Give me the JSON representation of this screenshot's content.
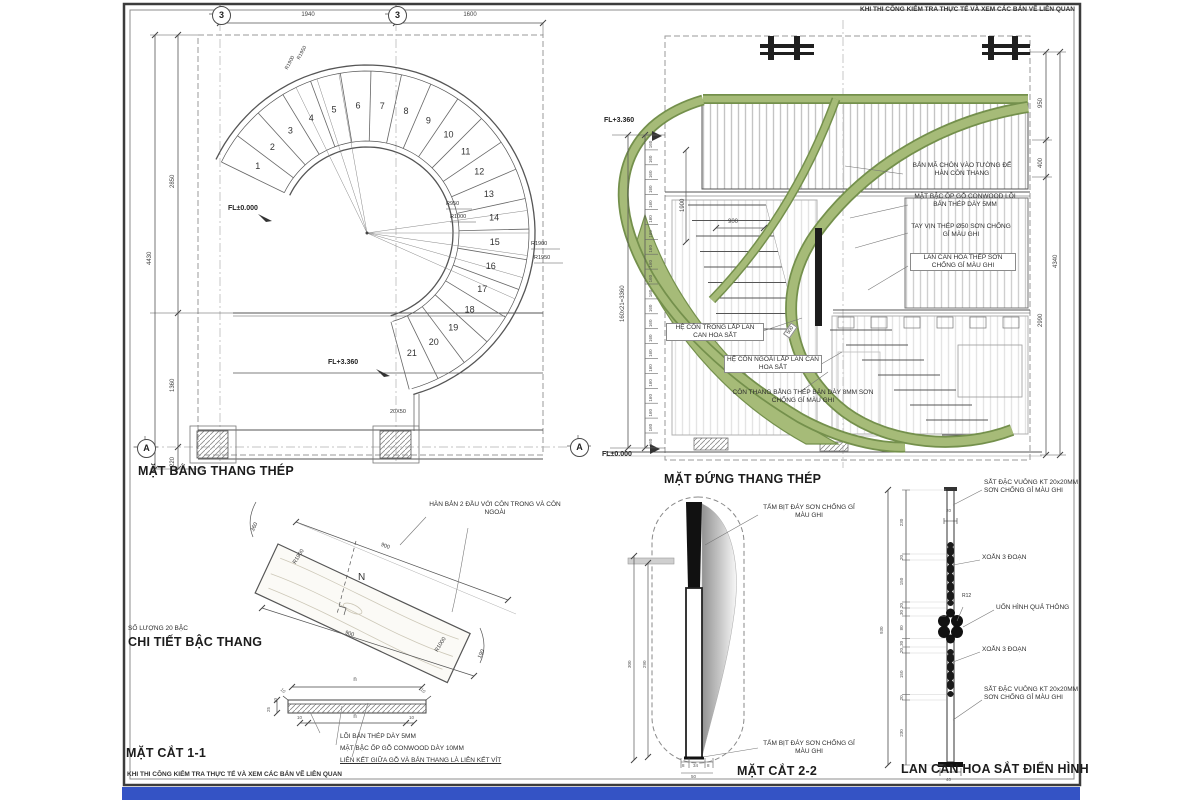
{
  "sheet_note": "KHI THI CÔNG KIỂM TRA THỰC TẾ VÀ XEM CÁC BẢN VẼ LIÊN QUAN",
  "colors": {
    "railing_green": "#a6bb78",
    "railing_green_dark": "#74904c",
    "blue_bar": "#3453c5",
    "line": "#555555"
  },
  "plan": {
    "title": "MẶT BẰNG THANG THÉP",
    "grid_cols": [
      "3",
      "3"
    ],
    "grid_rows": [
      "A",
      "A"
    ],
    "dims_top": [
      "1940",
      "1600"
    ],
    "dims_left": [
      "2850",
      "1360",
      "220"
    ],
    "dim_left_total": "4430",
    "level_base": "FL±0.000",
    "level_top": "FL+3.360",
    "radii_inner": [
      "R950",
      "R1000"
    ],
    "radii_outer": [
      "R1900",
      "R1950"
    ],
    "column_dim": "20X50",
    "steps": [
      "1",
      "2",
      "3",
      "4",
      "5",
      "6",
      "7",
      "8",
      "9",
      "10",
      "11",
      "12",
      "13",
      "14",
      "15",
      "16",
      "17",
      "18",
      "19",
      "20",
      "21"
    ]
  },
  "elevation": {
    "title": "MẶT ĐỨNG THANG THÉP",
    "level_top": "FL+3.360",
    "level_base": "FL±0.000",
    "riser_label": "160",
    "riser_formula": "160x21=3360",
    "dim_height": "1900",
    "dim_width": "900",
    "dim_stringer": "500",
    "dims_right": [
      "950",
      "400",
      "2990"
    ],
    "dim_right_total": "4340",
    "callout_plate": "BẢN MÃ CHÔN VÀO TƯỜNG ĐỂ HÀN CÔN THANG",
    "callout_tread": "MẶT BẬC ỐP GỖ CONWOOD LÕI BẢN THÉP DÀY 5MM",
    "callout_handrail": "TAY VỊN THÉP Ø50 SƠN CHỐNG GỈ MÀU GHI",
    "callout_railing": "LAN CAN HOA THÉP SƠN CHỐNG GỈ MÀU GHI",
    "callout_inner_stringer": "HỆ CÔN TRONG LẮP LAN CAN HOA SẮT",
    "callout_outer_stringer": "HỆ CÔN NGOÀI LẮP LAN CAN HOA SẮT",
    "callout_stringer_plate": "CÔN THANG BẰNG THÉP BẢN DÀY 8MM SƠN CHỐNG GỈ MÀU GHI"
  },
  "step_detail": {
    "qty_note": "SỐ LƯỢNG 20 BẬC",
    "title": "CHI TIẾT BẬC THANG",
    "callout_weld": "HÀN BẢN 2 ĐẦU VỚI CÔN TRONG VÀ CÔN NGOÀI",
    "dim_edge_outer": "900",
    "dim_edge_inner": "900",
    "dim_end_left": "360",
    "dim_end_right": "190",
    "radius_outer": "R1900",
    "radius_inner": "R1000",
    "axis_label": "N"
  },
  "section_1_1": {
    "title": "MẶT CẮT 1-1",
    "dim_top": "n",
    "dim_bottom": "n",
    "dim_corner": "10",
    "dim_end": "10",
    "dims_left": [
      "25",
      "10"
    ],
    "callouts": [
      "LÕI BẢN THÉP DÀY 5MM",
      "MẶT BẬC ỐP GỖ CONWOOD DÀY 10MM",
      "LIÊN KẾT GIỮA GỖ VÀ BẢN THANG LÀ LIÊN KẾT VÍT"
    ]
  },
  "section_2_2": {
    "title": "MẶT CẮT 2-2",
    "callout_cap_top": "TẤM BỊT ĐÁY SƠN CHỐNG GỈ MÀU GHI",
    "callout_cap_bottom": "TẤM BỊT ĐÁY SƠN CHỐNG GỈ MÀU GHI",
    "dim_height_outer": "300",
    "dim_height_inner": "290",
    "dims_bottom": [
      "8",
      "34",
      "8"
    ],
    "dim_bottom_total": "50"
  },
  "railing_detail": {
    "title": "LAN CAN HOA SẮT ĐIỂN HÌNH",
    "callout_bar_top": "SẮT ĐẶC VUÔNG KT 20x20MM SƠN CHỐNG GỈ MÀU GHI",
    "callout_bar_bottom": "SẮT ĐẶC VUÔNG KT 20x20MM SƠN CHỐNG GỈ MÀU GHI",
    "callout_twist_top": "XOẮN 3 ĐOẠN",
    "callout_twist_bottom": "XOẮN 3 ĐOẠN",
    "callout_ornament": "UỐN HÌNH QUẢ THÔNG",
    "ornament_radius": "R12",
    "dims_left": [
      "230",
      "20",
      "150",
      "20",
      "30",
      "80",
      "30",
      "20",
      "150",
      "20",
      "230"
    ],
    "dim_total": "930",
    "dim_bar_width": "20",
    "dim_base": "40"
  }
}
